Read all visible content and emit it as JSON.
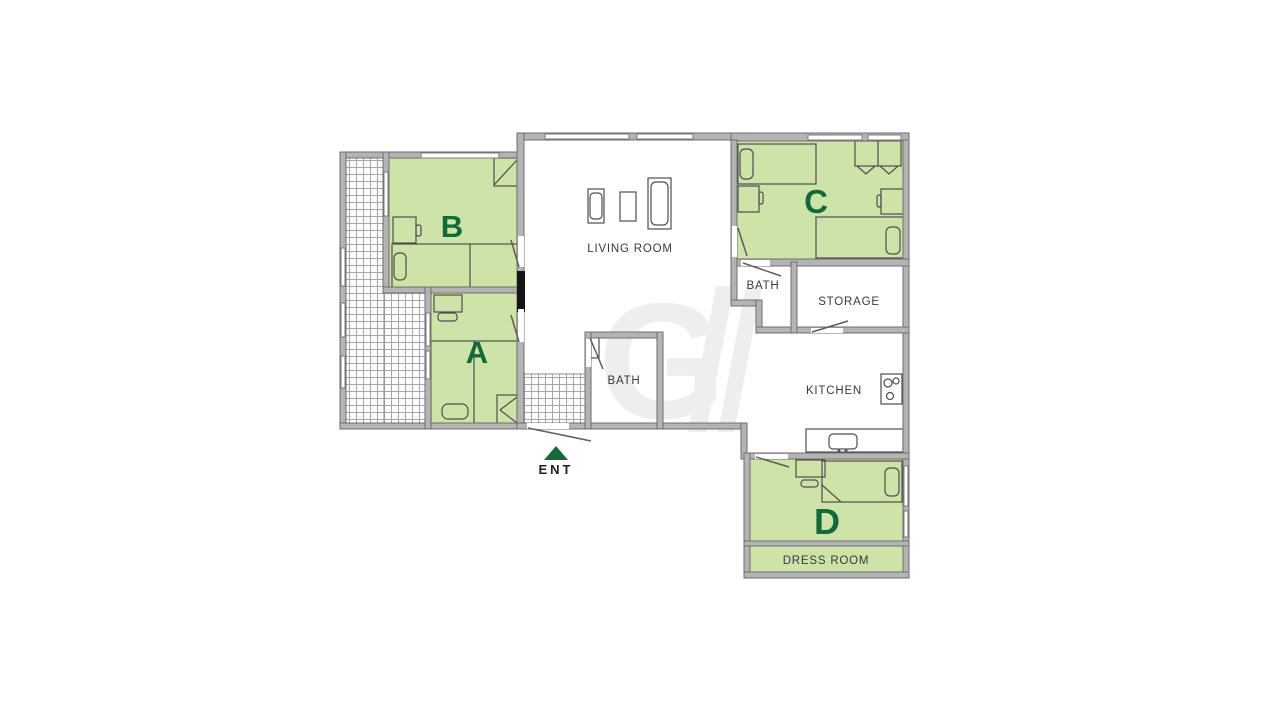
{
  "title": "Apartment floor plan",
  "rooms": {
    "living": {
      "label": "LIVING ROOM"
    },
    "bath_center": {
      "label": "BATH"
    },
    "bath_right": {
      "label": "BATH"
    },
    "storage": {
      "label": "STORAGE"
    },
    "kitchen": {
      "label": "KITCHEN"
    },
    "dress": {
      "label": "DRESS ROOM"
    },
    "bedroom_a": {
      "label": "A"
    },
    "bedroom_b": {
      "label": "B"
    },
    "bedroom_c": {
      "label": "C"
    },
    "bedroom_d": {
      "label": "D"
    }
  },
  "entrance": {
    "label": "ENT"
  },
  "colors": {
    "bedroom_fill": "#cde3a8",
    "label_green": "#156839",
    "wall_fill": "#b4b4b4",
    "wall_edge": "#6e6e6e",
    "text_dark": "#3a3a3a",
    "watermark": "#eeeeee"
  }
}
